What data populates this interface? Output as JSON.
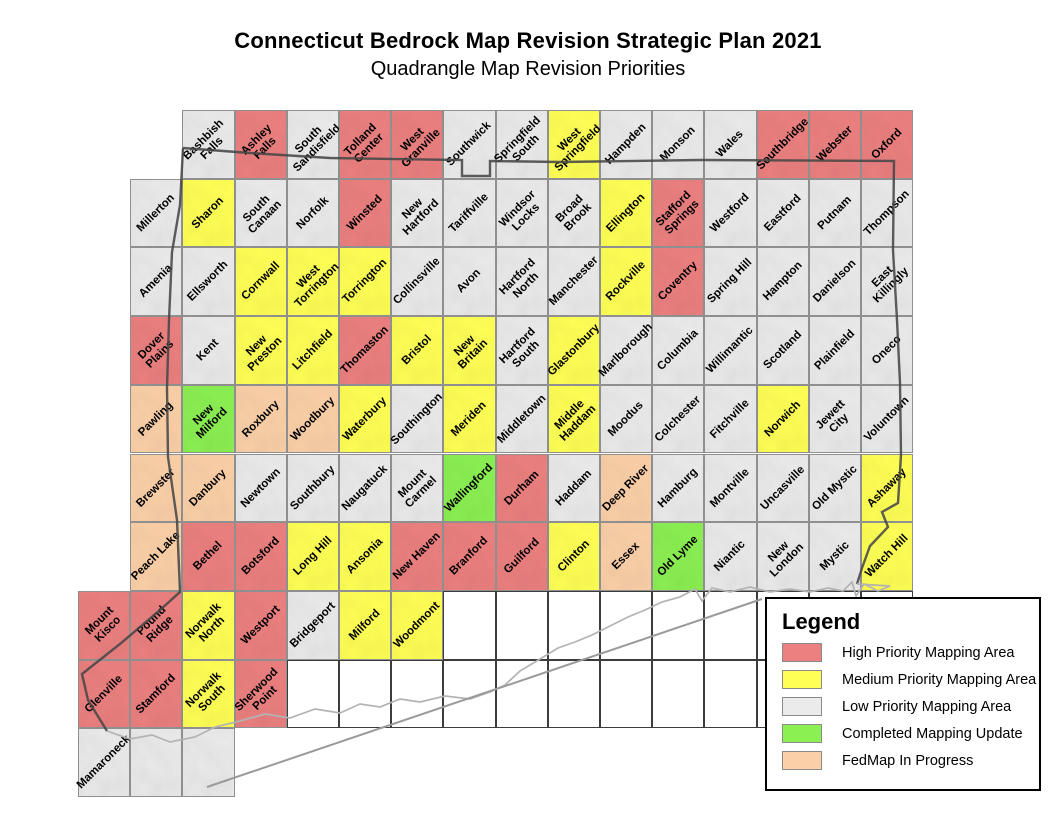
{
  "title": "Connecticut Bedrock Map Revision Strategic Plan 2021",
  "subtitle": "Quadrangle Map Revision Priorities",
  "priority_colors": {
    "h": "#EC8080",
    "m": "#FFFF55",
    "l": "#EBEBEB",
    "c": "#8BF052",
    "f": "#FBD0A8"
  },
  "legend": {
    "title": "Legend",
    "items": [
      {
        "key": "h",
        "label": "High Priority Mapping Area"
      },
      {
        "key": "m",
        "label": "Medium Priority Mapping Area"
      },
      {
        "key": "l",
        "label": "Low Priority Mapping Area"
      },
      {
        "key": "c",
        "label": "Completed Mapping Update"
      },
      {
        "key": "f",
        "label": "FedMap In Progress"
      }
    ]
  },
  "grid": {
    "x0": 78,
    "y0": 110,
    "cw": 52.2,
    "rh": 68.7,
    "cols": 16,
    "rows": 10
  },
  "quads": [
    {
      "n": "Bashbish\nFalls",
      "r": 1,
      "c": 3,
      "p": "l"
    },
    {
      "n": "Ashley\nFalls",
      "r": 1,
      "c": 4,
      "p": "h"
    },
    {
      "n": "South\nSandisfield",
      "r": 1,
      "c": 5,
      "p": "l"
    },
    {
      "n": "Tolland\nCenter",
      "r": 1,
      "c": 6,
      "p": "h"
    },
    {
      "n": "West\nGranville",
      "r": 1,
      "c": 7,
      "p": "h"
    },
    {
      "n": "Southwick",
      "r": 1,
      "c": 8,
      "p": "l"
    },
    {
      "n": "Springfield\nSouth",
      "r": 1,
      "c": 9,
      "p": "l"
    },
    {
      "n": "West\nSpringfield",
      "r": 1,
      "c": 10,
      "p": "m"
    },
    {
      "n": "Hampden",
      "r": 1,
      "c": 11,
      "p": "l"
    },
    {
      "n": "Monson",
      "r": 1,
      "c": 12,
      "p": "l"
    },
    {
      "n": "Wales",
      "r": 1,
      "c": 13,
      "p": "l"
    },
    {
      "n": "Southbridge",
      "r": 1,
      "c": 14,
      "p": "h"
    },
    {
      "n": "Webster",
      "r": 1,
      "c": 15,
      "p": "h"
    },
    {
      "n": "Oxford",
      "r": 1,
      "c": 16,
      "p": "h"
    },
    {
      "n": "Millerton",
      "r": 2,
      "c": 2,
      "p": "l"
    },
    {
      "n": "Sharon",
      "r": 2,
      "c": 3,
      "p": "m"
    },
    {
      "n": "South\nCanaan",
      "r": 2,
      "c": 4,
      "p": "l"
    },
    {
      "n": "Norfolk",
      "r": 2,
      "c": 5,
      "p": "l"
    },
    {
      "n": "Winsted",
      "r": 2,
      "c": 6,
      "p": "h"
    },
    {
      "n": "New\nHartford",
      "r": 2,
      "c": 7,
      "p": "l"
    },
    {
      "n": "Tariffville",
      "r": 2,
      "c": 8,
      "p": "l"
    },
    {
      "n": "Windsor\nLocks",
      "r": 2,
      "c": 9,
      "p": "l"
    },
    {
      "n": "Broad\nBrook",
      "r": 2,
      "c": 10,
      "p": "l"
    },
    {
      "n": "Ellington",
      "r": 2,
      "c": 11,
      "p": "m"
    },
    {
      "n": "Stafford\nSprings",
      "r": 2,
      "c": 12,
      "p": "h"
    },
    {
      "n": "Westford",
      "r": 2,
      "c": 13,
      "p": "l"
    },
    {
      "n": "Eastford",
      "r": 2,
      "c": 14,
      "p": "l"
    },
    {
      "n": "Putnam",
      "r": 2,
      "c": 15,
      "p": "l"
    },
    {
      "n": "Thompson",
      "r": 2,
      "c": 16,
      "p": "l"
    },
    {
      "n": "Amenia",
      "r": 3,
      "c": 2,
      "p": "l"
    },
    {
      "n": "Ellsworth",
      "r": 3,
      "c": 3,
      "p": "l"
    },
    {
      "n": "Cornwall",
      "r": 3,
      "c": 4,
      "p": "m"
    },
    {
      "n": "West\nTorrington",
      "r": 3,
      "c": 5,
      "p": "m"
    },
    {
      "n": "Torrington",
      "r": 3,
      "c": 6,
      "p": "m"
    },
    {
      "n": "Collinsville",
      "r": 3,
      "c": 7,
      "p": "l"
    },
    {
      "n": "Avon",
      "r": 3,
      "c": 8,
      "p": "l"
    },
    {
      "n": "Hartford\nNorth",
      "r": 3,
      "c": 9,
      "p": "l"
    },
    {
      "n": "Manchester",
      "r": 3,
      "c": 10,
      "p": "l"
    },
    {
      "n": "Rockville",
      "r": 3,
      "c": 11,
      "p": "m"
    },
    {
      "n": "Coventry",
      "r": 3,
      "c": 12,
      "p": "h"
    },
    {
      "n": "Spring Hill",
      "r": 3,
      "c": 13,
      "p": "l"
    },
    {
      "n": "Hampton",
      "r": 3,
      "c": 14,
      "p": "l"
    },
    {
      "n": "Danielson",
      "r": 3,
      "c": 15,
      "p": "l"
    },
    {
      "n": "East\nKillingly",
      "r": 3,
      "c": 16,
      "p": "l"
    },
    {
      "n": "Dover\nPlains",
      "r": 4,
      "c": 2,
      "p": "h"
    },
    {
      "n": "Kent",
      "r": 4,
      "c": 3,
      "p": "l"
    },
    {
      "n": "New\nPreston",
      "r": 4,
      "c": 4,
      "p": "m"
    },
    {
      "n": "Litchfield",
      "r": 4,
      "c": 5,
      "p": "m"
    },
    {
      "n": "Thomaston",
      "r": 4,
      "c": 6,
      "p": "h"
    },
    {
      "n": "Bristol",
      "r": 4,
      "c": 7,
      "p": "m"
    },
    {
      "n": "New\nBritain",
      "r": 4,
      "c": 8,
      "p": "m"
    },
    {
      "n": "Hartford\nSouth",
      "r": 4,
      "c": 9,
      "p": "l"
    },
    {
      "n": "Glastonbury",
      "r": 4,
      "c": 10,
      "p": "m"
    },
    {
      "n": "Marlborough",
      "r": 4,
      "c": 11,
      "p": "l"
    },
    {
      "n": "Columbia",
      "r": 4,
      "c": 12,
      "p": "l"
    },
    {
      "n": "Willimantic",
      "r": 4,
      "c": 13,
      "p": "l"
    },
    {
      "n": "Scotland",
      "r": 4,
      "c": 14,
      "p": "l"
    },
    {
      "n": "Plainfield",
      "r": 4,
      "c": 15,
      "p": "l"
    },
    {
      "n": "Oneco",
      "r": 4,
      "c": 16,
      "p": "l"
    },
    {
      "n": "Pawling",
      "r": 5,
      "c": 2,
      "p": "f"
    },
    {
      "n": "New\nMilford",
      "r": 5,
      "c": 3,
      "p": "c"
    },
    {
      "n": "Roxbury",
      "r": 5,
      "c": 4,
      "p": "f"
    },
    {
      "n": "Woodbury",
      "r": 5,
      "c": 5,
      "p": "f"
    },
    {
      "n": "Waterbury",
      "r": 5,
      "c": 6,
      "p": "m"
    },
    {
      "n": "Southington",
      "r": 5,
      "c": 7,
      "p": "l"
    },
    {
      "n": "Meriden",
      "r": 5,
      "c": 8,
      "p": "m"
    },
    {
      "n": "Middletown",
      "r": 5,
      "c": 9,
      "p": "l"
    },
    {
      "n": "Middle\nHaddam",
      "r": 5,
      "c": 10,
      "p": "m"
    },
    {
      "n": "Moodus",
      "r": 5,
      "c": 11,
      "p": "l"
    },
    {
      "n": "Colchester",
      "r": 5,
      "c": 12,
      "p": "l"
    },
    {
      "n": "Fitchville",
      "r": 5,
      "c": 13,
      "p": "l"
    },
    {
      "n": "Norwich",
      "r": 5,
      "c": 14,
      "p": "m"
    },
    {
      "n": "Jewett\nCity",
      "r": 5,
      "c": 15,
      "p": "l"
    },
    {
      "n": "Voluntown",
      "r": 5,
      "c": 16,
      "p": "l"
    },
    {
      "n": "Brewster",
      "r": 6,
      "c": 2,
      "p": "f"
    },
    {
      "n": "Danbury",
      "r": 6,
      "c": 3,
      "p": "f"
    },
    {
      "n": "Newtown",
      "r": 6,
      "c": 4,
      "p": "l"
    },
    {
      "n": "Southbury",
      "r": 6,
      "c": 5,
      "p": "l"
    },
    {
      "n": "Naugatuck",
      "r": 6,
      "c": 6,
      "p": "l"
    },
    {
      "n": "Mount\nCarmel",
      "r": 6,
      "c": 7,
      "p": "l"
    },
    {
      "n": "Wallingford",
      "r": 6,
      "c": 8,
      "p": "c"
    },
    {
      "n": "Durham",
      "r": 6,
      "c": 9,
      "p": "h"
    },
    {
      "n": "Haddam",
      "r": 6,
      "c": 10,
      "p": "l"
    },
    {
      "n": "Deep River",
      "r": 6,
      "c": 11,
      "p": "f"
    },
    {
      "n": "Hamburg",
      "r": 6,
      "c": 12,
      "p": "l"
    },
    {
      "n": "Montville",
      "r": 6,
      "c": 13,
      "p": "l"
    },
    {
      "n": "Uncasville",
      "r": 6,
      "c": 14,
      "p": "l"
    },
    {
      "n": "Old Mystic",
      "r": 6,
      "c": 15,
      "p": "l"
    },
    {
      "n": "Ashaway",
      "r": 6,
      "c": 16,
      "p": "m"
    },
    {
      "n": "Peach Lake",
      "r": 7,
      "c": 2,
      "p": "f"
    },
    {
      "n": "Bethel",
      "r": 7,
      "c": 3,
      "p": "h"
    },
    {
      "n": "Botsford",
      "r": 7,
      "c": 4,
      "p": "h"
    },
    {
      "n": "Long Hill",
      "r": 7,
      "c": 5,
      "p": "m"
    },
    {
      "n": "Ansonia",
      "r": 7,
      "c": 6,
      "p": "m"
    },
    {
      "n": "New Haven",
      "r": 7,
      "c": 7,
      "p": "h"
    },
    {
      "n": "Branford",
      "r": 7,
      "c": 8,
      "p": "h"
    },
    {
      "n": "Guilford",
      "r": 7,
      "c": 9,
      "p": "h"
    },
    {
      "n": "Clinton",
      "r": 7,
      "c": 10,
      "p": "m"
    },
    {
      "n": "Essex",
      "r": 7,
      "c": 11,
      "p": "f"
    },
    {
      "n": "Old Lyme",
      "r": 7,
      "c": 12,
      "p": "c"
    },
    {
      "n": "Niantic",
      "r": 7,
      "c": 13,
      "p": "l"
    },
    {
      "n": "New\nLondon",
      "r": 7,
      "c": 14,
      "p": "l"
    },
    {
      "n": "Mystic",
      "r": 7,
      "c": 15,
      "p": "l"
    },
    {
      "n": "Watch Hill",
      "r": 7,
      "c": 16,
      "p": "m"
    },
    {
      "n": "Mount\nKisco",
      "r": 8,
      "c": 1,
      "p": "h"
    },
    {
      "n": "Pound\nRidge",
      "r": 8,
      "c": 2,
      "p": "h"
    },
    {
      "n": "Norwalk\nNorth",
      "r": 8,
      "c": 3,
      "p": "m"
    },
    {
      "n": "Westport",
      "r": 8,
      "c": 4,
      "p": "h"
    },
    {
      "n": "Bridgeport",
      "r": 8,
      "c": 5,
      "p": "l"
    },
    {
      "n": "Milford",
      "r": 8,
      "c": 6,
      "p": "m"
    },
    {
      "n": "Woodmont",
      "r": 8,
      "c": 7,
      "p": "m"
    },
    {
      "n": "Glenville",
      "r": 9,
      "c": 1,
      "p": "h"
    },
    {
      "n": "Stamford",
      "r": 9,
      "c": 2,
      "p": "h"
    },
    {
      "n": "Norwalk\nSouth",
      "r": 9,
      "c": 3,
      "p": "m"
    },
    {
      "n": "Sherwood\nPoint",
      "r": 9,
      "c": 4,
      "p": "h"
    },
    {
      "n": "Mamaroneck",
      "r": 10,
      "c": 1,
      "p": "l"
    },
    {
      "n": "",
      "r": 10,
      "c": 2,
      "p": "l"
    },
    {
      "n": "",
      "r": 10,
      "c": 3,
      "p": "l"
    }
  ],
  "empty_cells": [
    {
      "row": 8,
      "col_start": 8,
      "col_end": 16
    },
    {
      "row": 9,
      "col_start": 5,
      "col_end": 16
    }
  ]
}
